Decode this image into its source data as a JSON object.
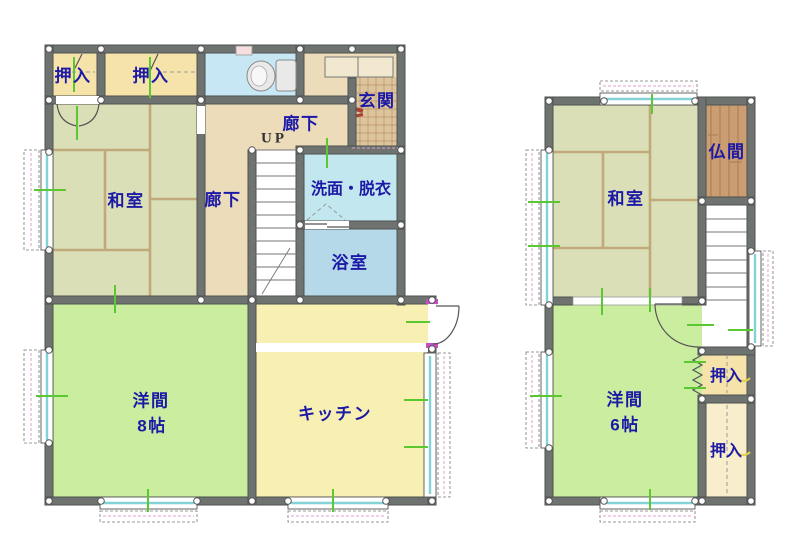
{
  "colors": {
    "wall": "#6e7370",
    "label": "#1b19a6",
    "tatami": "#dadfb8",
    "tatami_line": "#c2a97b",
    "closet": "#f6e3aa",
    "closet_light": "#f8eecb",
    "hall": "#eddcba",
    "toilet_room": "#c8e7f4",
    "entrance_tile": "#dcc59d",
    "washroom": "#c3e7ee",
    "bath": "#b6d9e9",
    "western_room": "#cbeda0",
    "kitchen": "#f7f0b2",
    "altar_room": "#cb9d72",
    "window_glass": "#82d2d8",
    "opening_mark": "#5bc832",
    "hinge_mark": "#c44fc4"
  },
  "floor1": {
    "rooms": {
      "closet_a": "押入",
      "closet_b": "押入",
      "entrance": "玄関",
      "hall_upper": "廊下",
      "stairs": "UP",
      "corridor": "廊下",
      "japanese_room": "和室",
      "washroom": "洗面・脱衣",
      "bathroom": "浴室",
      "western_room": "洋間",
      "western_room_size": "8帖",
      "kitchen": "キッチン"
    }
  },
  "floor2": {
    "rooms": {
      "japanese_room": "和室",
      "altar_room": "仏間",
      "closet_upper": "押入",
      "western_room": "洋間",
      "western_room_size": "6帖",
      "closet_lower": "押入"
    }
  }
}
